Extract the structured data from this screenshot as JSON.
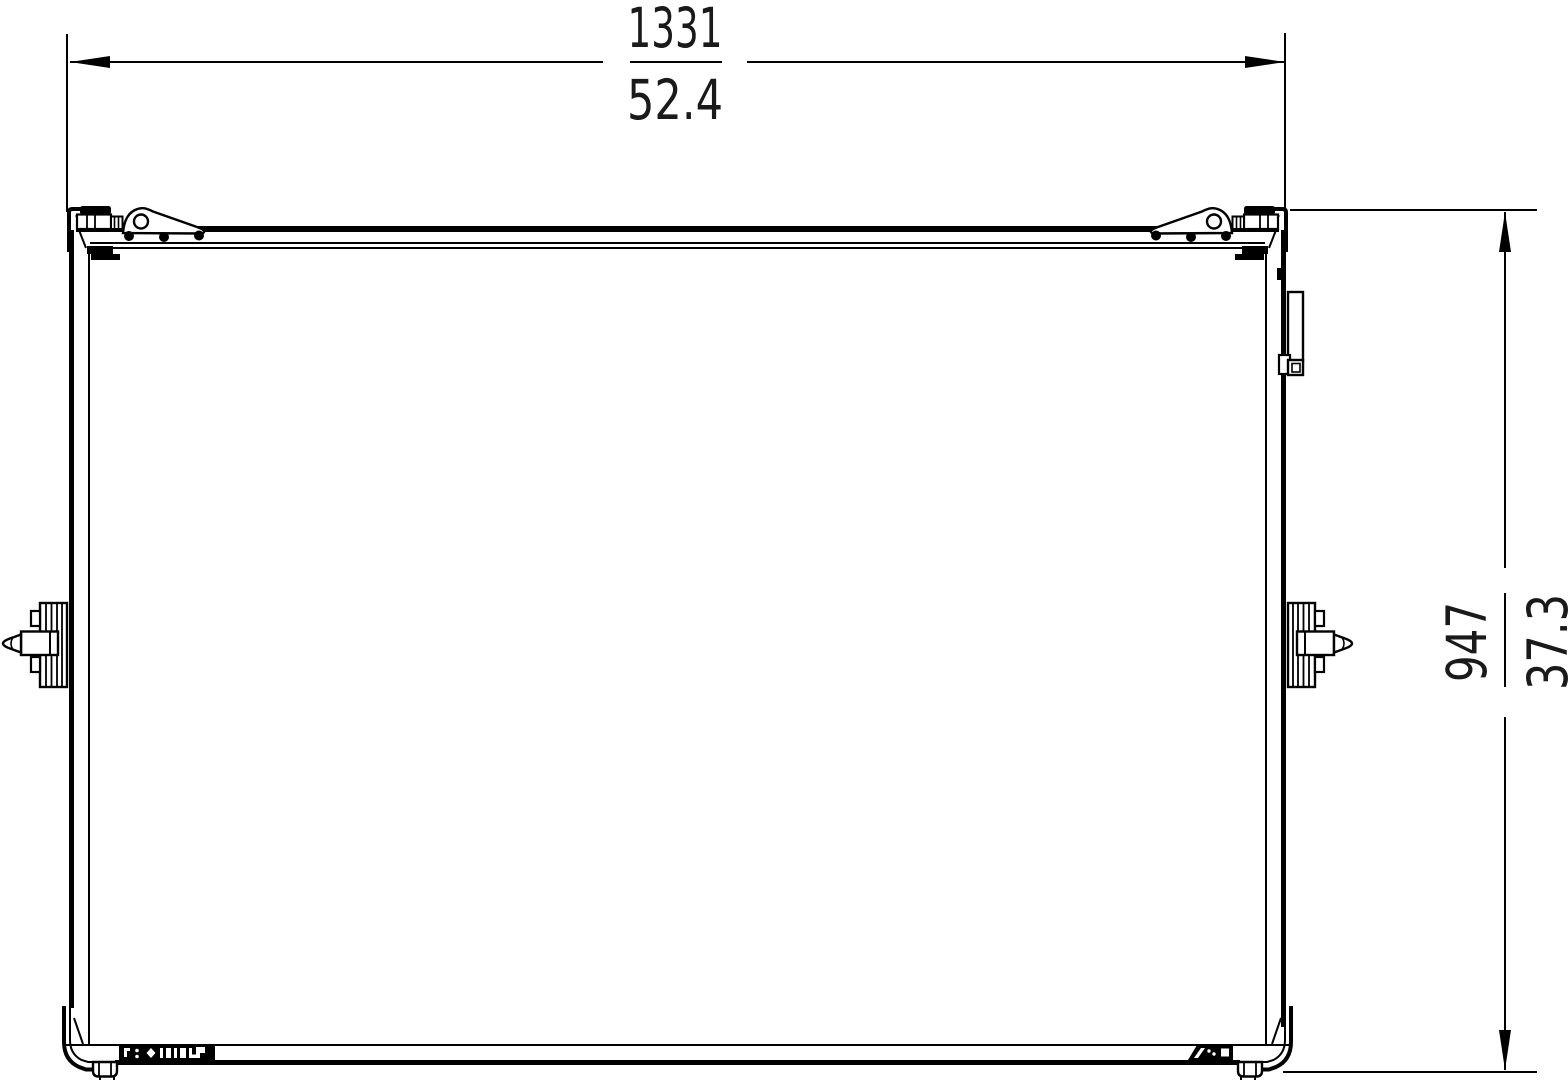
{
  "page": {
    "background": "#ffffff"
  },
  "drawing": {
    "line_color": "#000000",
    "text_color": "#1a1a1a",
    "dim_width": {
      "primary": "1331",
      "secondary": "52.4"
    },
    "dim_height": {
      "primary": "947",
      "secondary": "37.3"
    },
    "icons": {
      "hinge": "lid-hinge-plate",
      "top_latch": "butterfly-latch",
      "side_latch": "twist-latch-pin",
      "corner": "case-corner-bracket",
      "foot": "stacking-foot",
      "antenna": "side-bracket-handle",
      "logo_band": "illegible-brand-logo-band",
      "corner_label": "illegible-slanted-label"
    }
  }
}
